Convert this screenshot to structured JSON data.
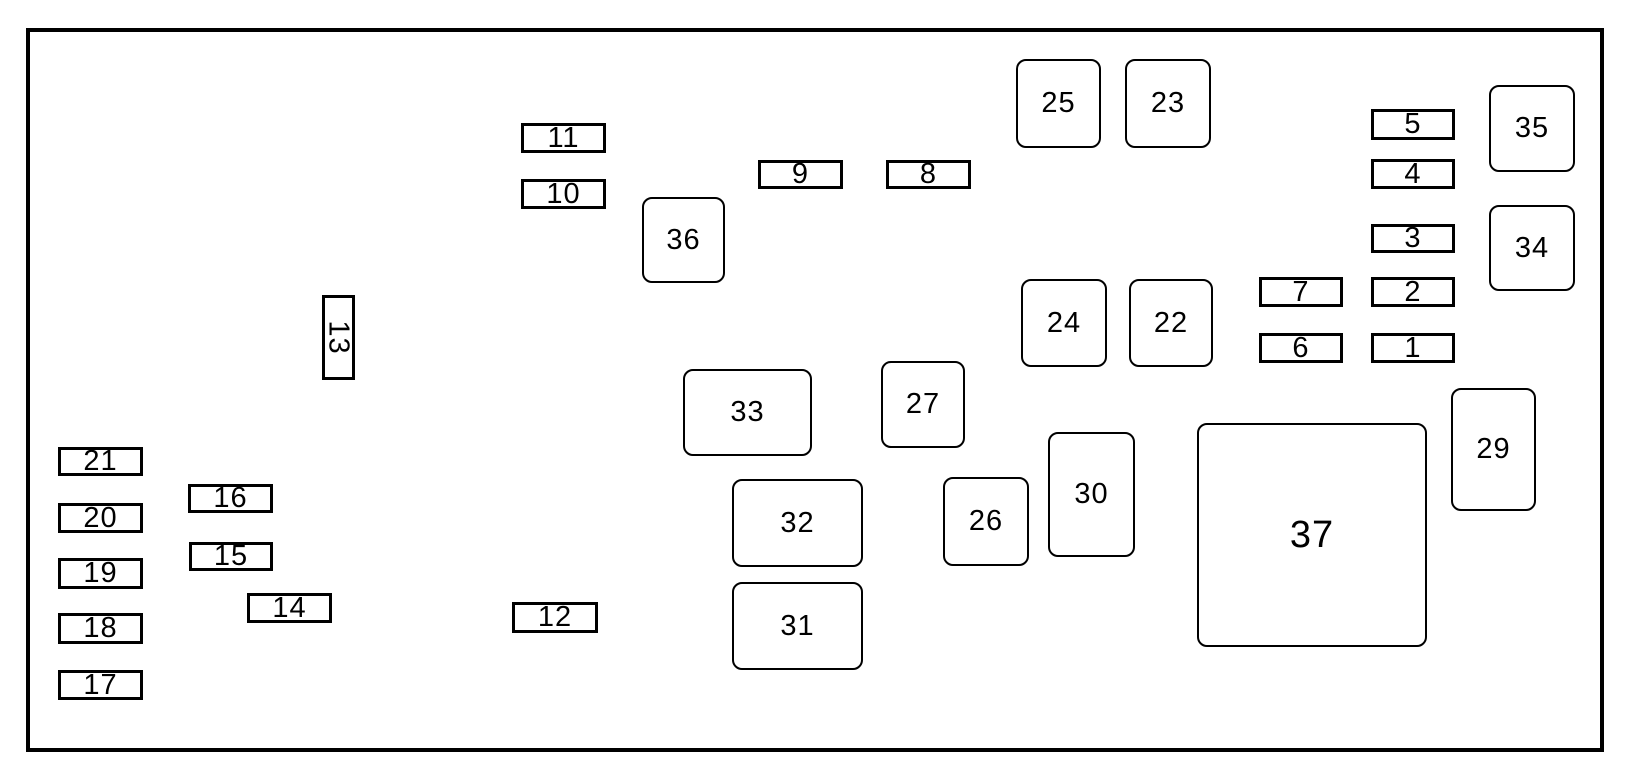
{
  "diagram": {
    "background_color": "#ffffff",
    "line_color": "#000000",
    "frame": {
      "x": 26,
      "y": 28,
      "width": 1578,
      "height": 724,
      "border_width": 4
    },
    "boxes": [
      {
        "label": "1",
        "shape": "rect",
        "x": 1371,
        "y": 333,
        "w": 84,
        "h": 30
      },
      {
        "label": "2",
        "shape": "rect",
        "x": 1371,
        "y": 277,
        "w": 84,
        "h": 30
      },
      {
        "label": "3",
        "shape": "rect",
        "x": 1371,
        "y": 224,
        "w": 84,
        "h": 29
      },
      {
        "label": "4",
        "shape": "rect",
        "x": 1371,
        "y": 159,
        "w": 84,
        "h": 30
      },
      {
        "label": "5",
        "shape": "rect",
        "x": 1371,
        "y": 109,
        "w": 84,
        "h": 31
      },
      {
        "label": "6",
        "shape": "rect",
        "x": 1259,
        "y": 333,
        "w": 84,
        "h": 30
      },
      {
        "label": "7",
        "shape": "rect",
        "x": 1259,
        "y": 277,
        "w": 84,
        "h": 30
      },
      {
        "label": "8",
        "shape": "rect",
        "x": 886,
        "y": 160,
        "w": 85,
        "h": 29
      },
      {
        "label": "9",
        "shape": "rect",
        "x": 758,
        "y": 160,
        "w": 85,
        "h": 29
      },
      {
        "label": "10",
        "shape": "rect",
        "x": 521,
        "y": 179,
        "w": 85,
        "h": 30
      },
      {
        "label": "11",
        "shape": "rect",
        "x": 521,
        "y": 123,
        "w": 85,
        "h": 30
      },
      {
        "label": "12",
        "shape": "rect",
        "x": 512,
        "y": 602,
        "w": 86,
        "h": 31
      },
      {
        "label": "13",
        "shape": "rect",
        "x": 322,
        "y": 295,
        "w": 33,
        "h": 85,
        "rotated": true
      },
      {
        "label": "14",
        "shape": "rect",
        "x": 247,
        "y": 593,
        "w": 85,
        "h": 30
      },
      {
        "label": "15",
        "shape": "rect",
        "x": 189,
        "y": 542,
        "w": 84,
        "h": 29
      },
      {
        "label": "16",
        "shape": "rect",
        "x": 188,
        "y": 484,
        "w": 85,
        "h": 29
      },
      {
        "label": "17",
        "shape": "rect",
        "x": 58,
        "y": 670,
        "w": 85,
        "h": 30
      },
      {
        "label": "18",
        "shape": "rect",
        "x": 58,
        "y": 613,
        "w": 85,
        "h": 31
      },
      {
        "label": "19",
        "shape": "rect",
        "x": 58,
        "y": 558,
        "w": 85,
        "h": 31
      },
      {
        "label": "20",
        "shape": "rect",
        "x": 58,
        "y": 503,
        "w": 85,
        "h": 30
      },
      {
        "label": "21",
        "shape": "rect",
        "x": 58,
        "y": 447,
        "w": 85,
        "h": 29
      },
      {
        "label": "22",
        "shape": "rounded",
        "x": 1129,
        "y": 279,
        "w": 84,
        "h": 88
      },
      {
        "label": "23",
        "shape": "rounded",
        "x": 1125,
        "y": 59,
        "w": 86,
        "h": 89
      },
      {
        "label": "24",
        "shape": "rounded",
        "x": 1021,
        "y": 279,
        "w": 86,
        "h": 88
      },
      {
        "label": "25",
        "shape": "rounded",
        "x": 1016,
        "y": 59,
        "w": 85,
        "h": 89
      },
      {
        "label": "26",
        "shape": "rounded",
        "x": 943,
        "y": 477,
        "w": 86,
        "h": 89
      },
      {
        "label": "27",
        "shape": "rounded",
        "x": 881,
        "y": 361,
        "w": 84,
        "h": 87
      },
      {
        "label": "29",
        "shape": "rounded",
        "x": 1451,
        "y": 388,
        "w": 85,
        "h": 123
      },
      {
        "label": "30",
        "shape": "rounded",
        "x": 1048,
        "y": 432,
        "w": 87,
        "h": 125
      },
      {
        "label": "31",
        "shape": "rounded",
        "x": 732,
        "y": 582,
        "w": 131,
        "h": 88
      },
      {
        "label": "32",
        "shape": "rounded",
        "x": 732,
        "y": 479,
        "w": 131,
        "h": 88
      },
      {
        "label": "33",
        "shape": "rounded",
        "x": 683,
        "y": 369,
        "w": 129,
        "h": 87
      },
      {
        "label": "34",
        "shape": "rounded",
        "x": 1489,
        "y": 205,
        "w": 86,
        "h": 86
      },
      {
        "label": "35",
        "shape": "rounded",
        "x": 1489,
        "y": 85,
        "w": 86,
        "h": 87
      },
      {
        "label": "36",
        "shape": "rounded",
        "x": 642,
        "y": 197,
        "w": 83,
        "h": 86
      },
      {
        "label": "37",
        "shape": "rounded",
        "x": 1197,
        "y": 423,
        "w": 230,
        "h": 224
      }
    ]
  }
}
